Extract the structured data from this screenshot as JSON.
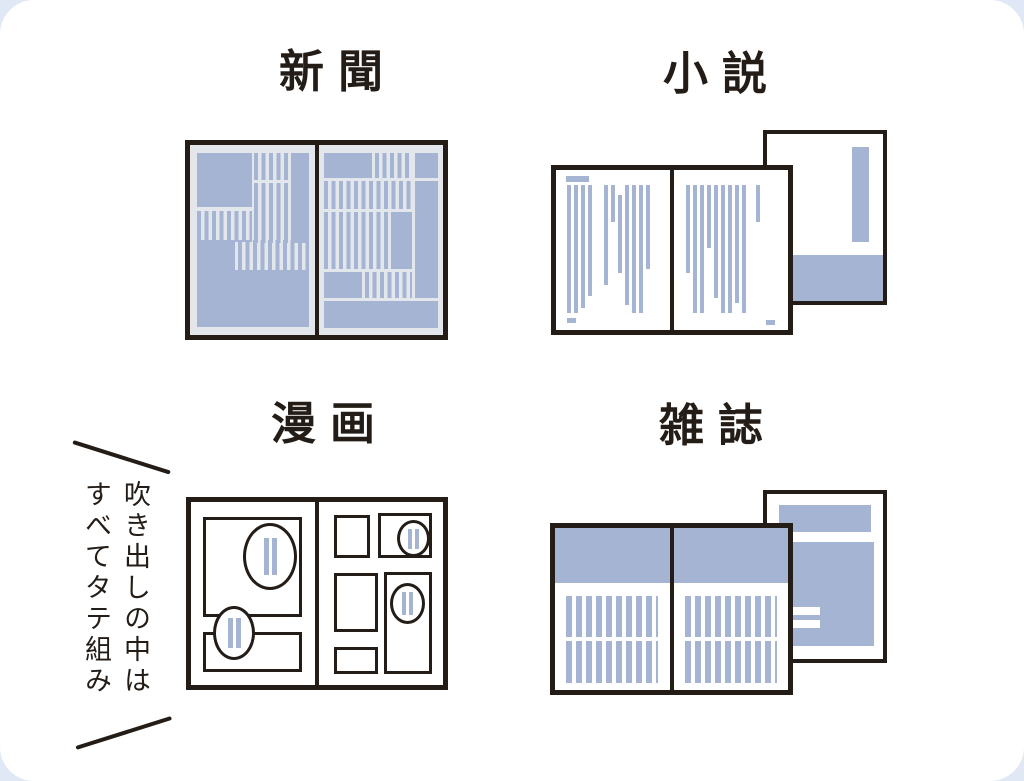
{
  "colors": {
    "ink": "#241d17",
    "accent_blue": "#a4b4d2",
    "newsprint_bg": "#e3e7eb",
    "paper_white": "#ffffff",
    "page_bg": "#dfe8f4",
    "card_bg": "#ffffff"
  },
  "sections": [
    {
      "id": "newspaper",
      "label": "新聞"
    },
    {
      "id": "novel",
      "label": "小説"
    },
    {
      "id": "manga",
      "label": "漫画"
    },
    {
      "id": "magazine",
      "label": "雑誌"
    }
  ],
  "annotation": {
    "lines": [
      "吹き出しの中は",
      "すべてタテ組み"
    ],
    "full_text": "吹き出しの中はすべてタテ組み"
  }
}
